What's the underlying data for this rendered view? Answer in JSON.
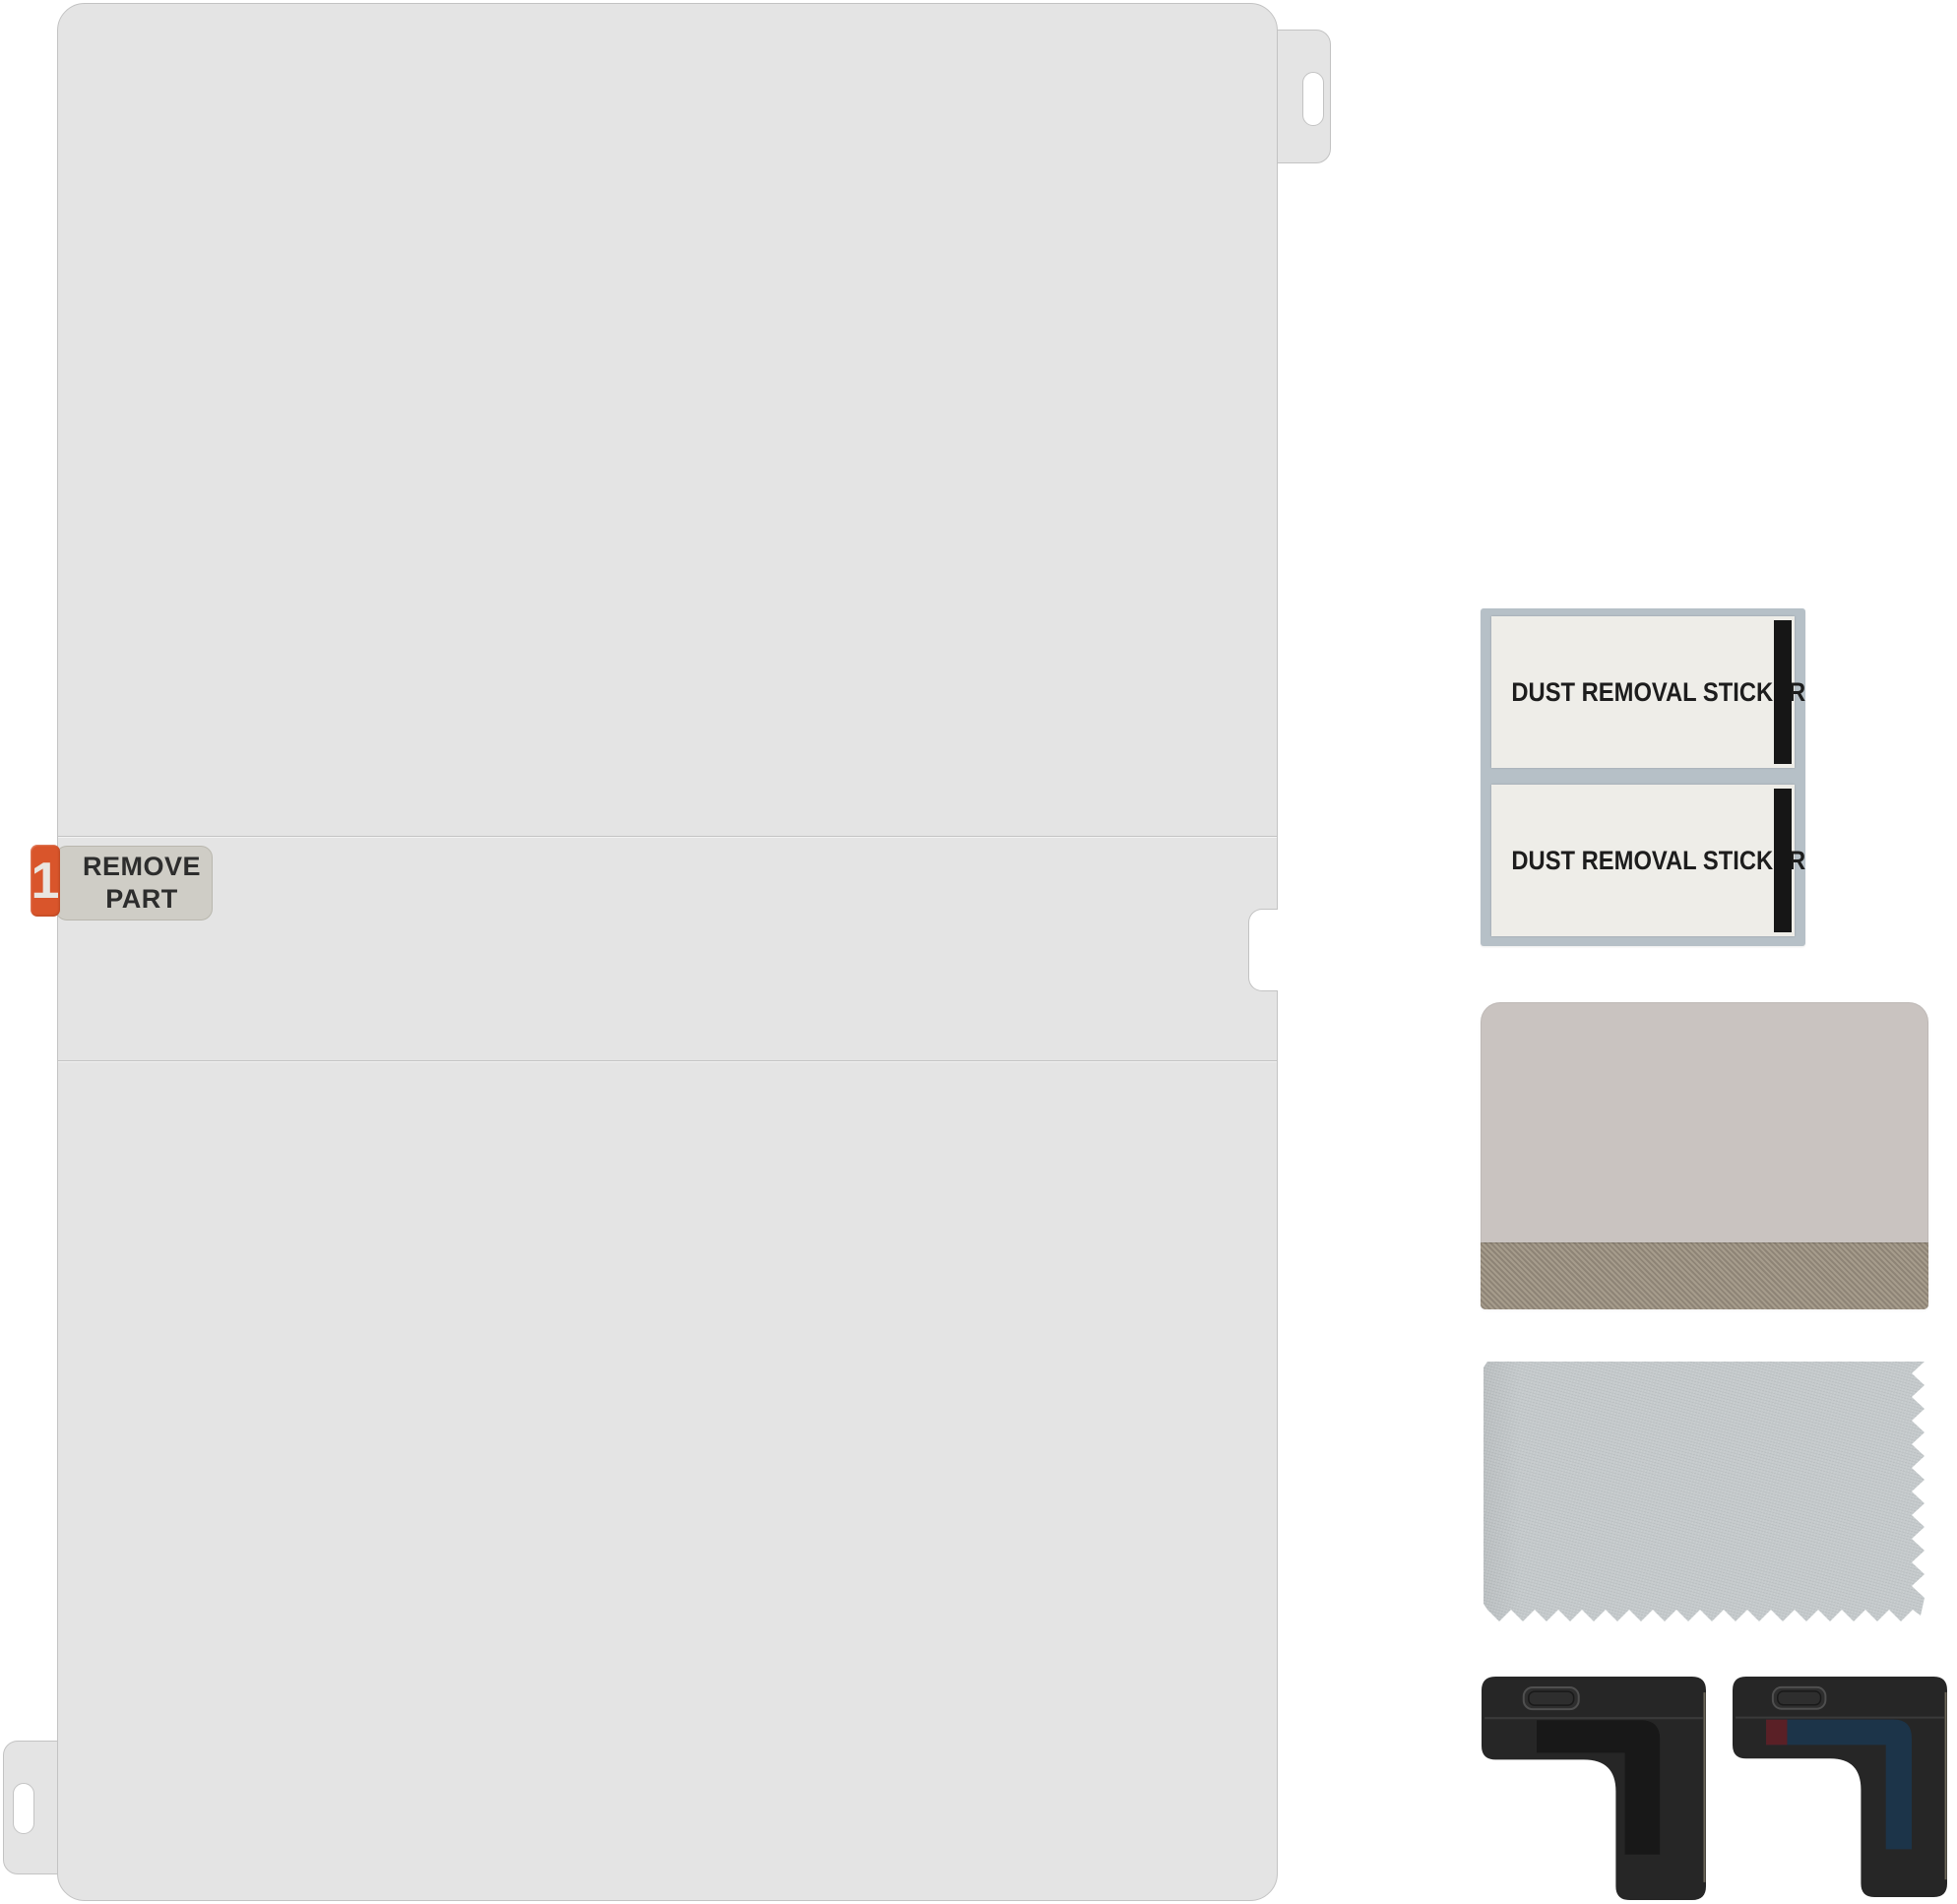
{
  "film": {
    "step_sticker": {
      "number": "1",
      "line1": "REMOVE",
      "line2": "PART"
    },
    "colors": {
      "sheet": "#e4e4e4",
      "outline": "#c3c3c3",
      "step_tab_orange": "#d9552b",
      "step_label_bg": "#cfcdc6",
      "step_label_text": "#2d2d2d"
    }
  },
  "dust_stickers": {
    "items": [
      {
        "label": "DUST REMOVAL STICKER"
      },
      {
        "label": "DUST REMOVAL STICKER"
      }
    ],
    "colors": {
      "backing": "#b6c0c7",
      "sticker": "#eeede8",
      "end_bar": "#161616",
      "text": "#1d1d1d"
    }
  },
  "squeegee": {
    "colors": {
      "body": "#c9c3c0",
      "felt_edge": "#9a9083"
    }
  },
  "cloth": {
    "colors": {
      "fabric": "#c5cacc"
    }
  },
  "corner_guides": {
    "body_color": "#262626",
    "items": [
      {
        "inner_color": "#181818",
        "accent_color": ""
      },
      {
        "inner_color": "#1c3449",
        "accent_color": "#5a2026"
      }
    ]
  }
}
